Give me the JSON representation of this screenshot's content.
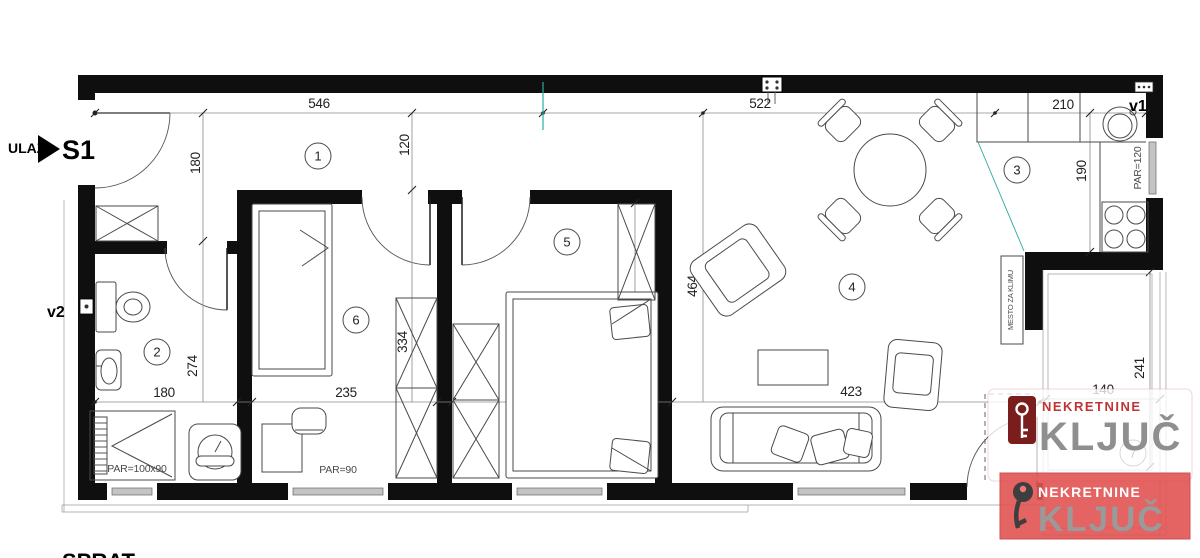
{
  "entrance": {
    "label": "ULAZ",
    "unit": "S1"
  },
  "vent_labels": {
    "v1": "v1",
    "v2": "v2"
  },
  "rooms": [
    {
      "number": "1"
    },
    {
      "number": "2"
    },
    {
      "number": "3"
    },
    {
      "number": "4"
    },
    {
      "number": "5"
    },
    {
      "number": "6"
    },
    {
      "number": "7"
    }
  ],
  "dimensions": {
    "hall_width_top": "546",
    "living_width_top": "522",
    "kitchen_width_top": "210",
    "hall_depth": "180",
    "hall_passage": "120",
    "kitchen_depth": "190",
    "living_depth": "464",
    "room6_depth": "334",
    "room5_depth": "334",
    "bath_depth": "274",
    "bath_width": "180",
    "room6_width": "235",
    "room5_width": "260",
    "living_width_bottom": "423",
    "terrace_width": "140",
    "terrace_depth": "241"
  },
  "window_labels": {
    "bath": "PAR=100x90",
    "room6": "PAR=90",
    "room5": "PAR=90",
    "living": "PAR=90",
    "kitchen": "PAR=120"
  },
  "notes": {
    "ac_spot": "MESTO ZA KLIMU",
    "floor_caption": "SPRAT"
  },
  "watermark": {
    "brand_line": "NEKRETNINE",
    "brand_name": "KLJUČ"
  },
  "colors": {
    "brand_red": "#c03434",
    "key_box_red": "#7a1d1d",
    "banner_red": "#e25353",
    "brand_gray": "#8f8f8f"
  }
}
